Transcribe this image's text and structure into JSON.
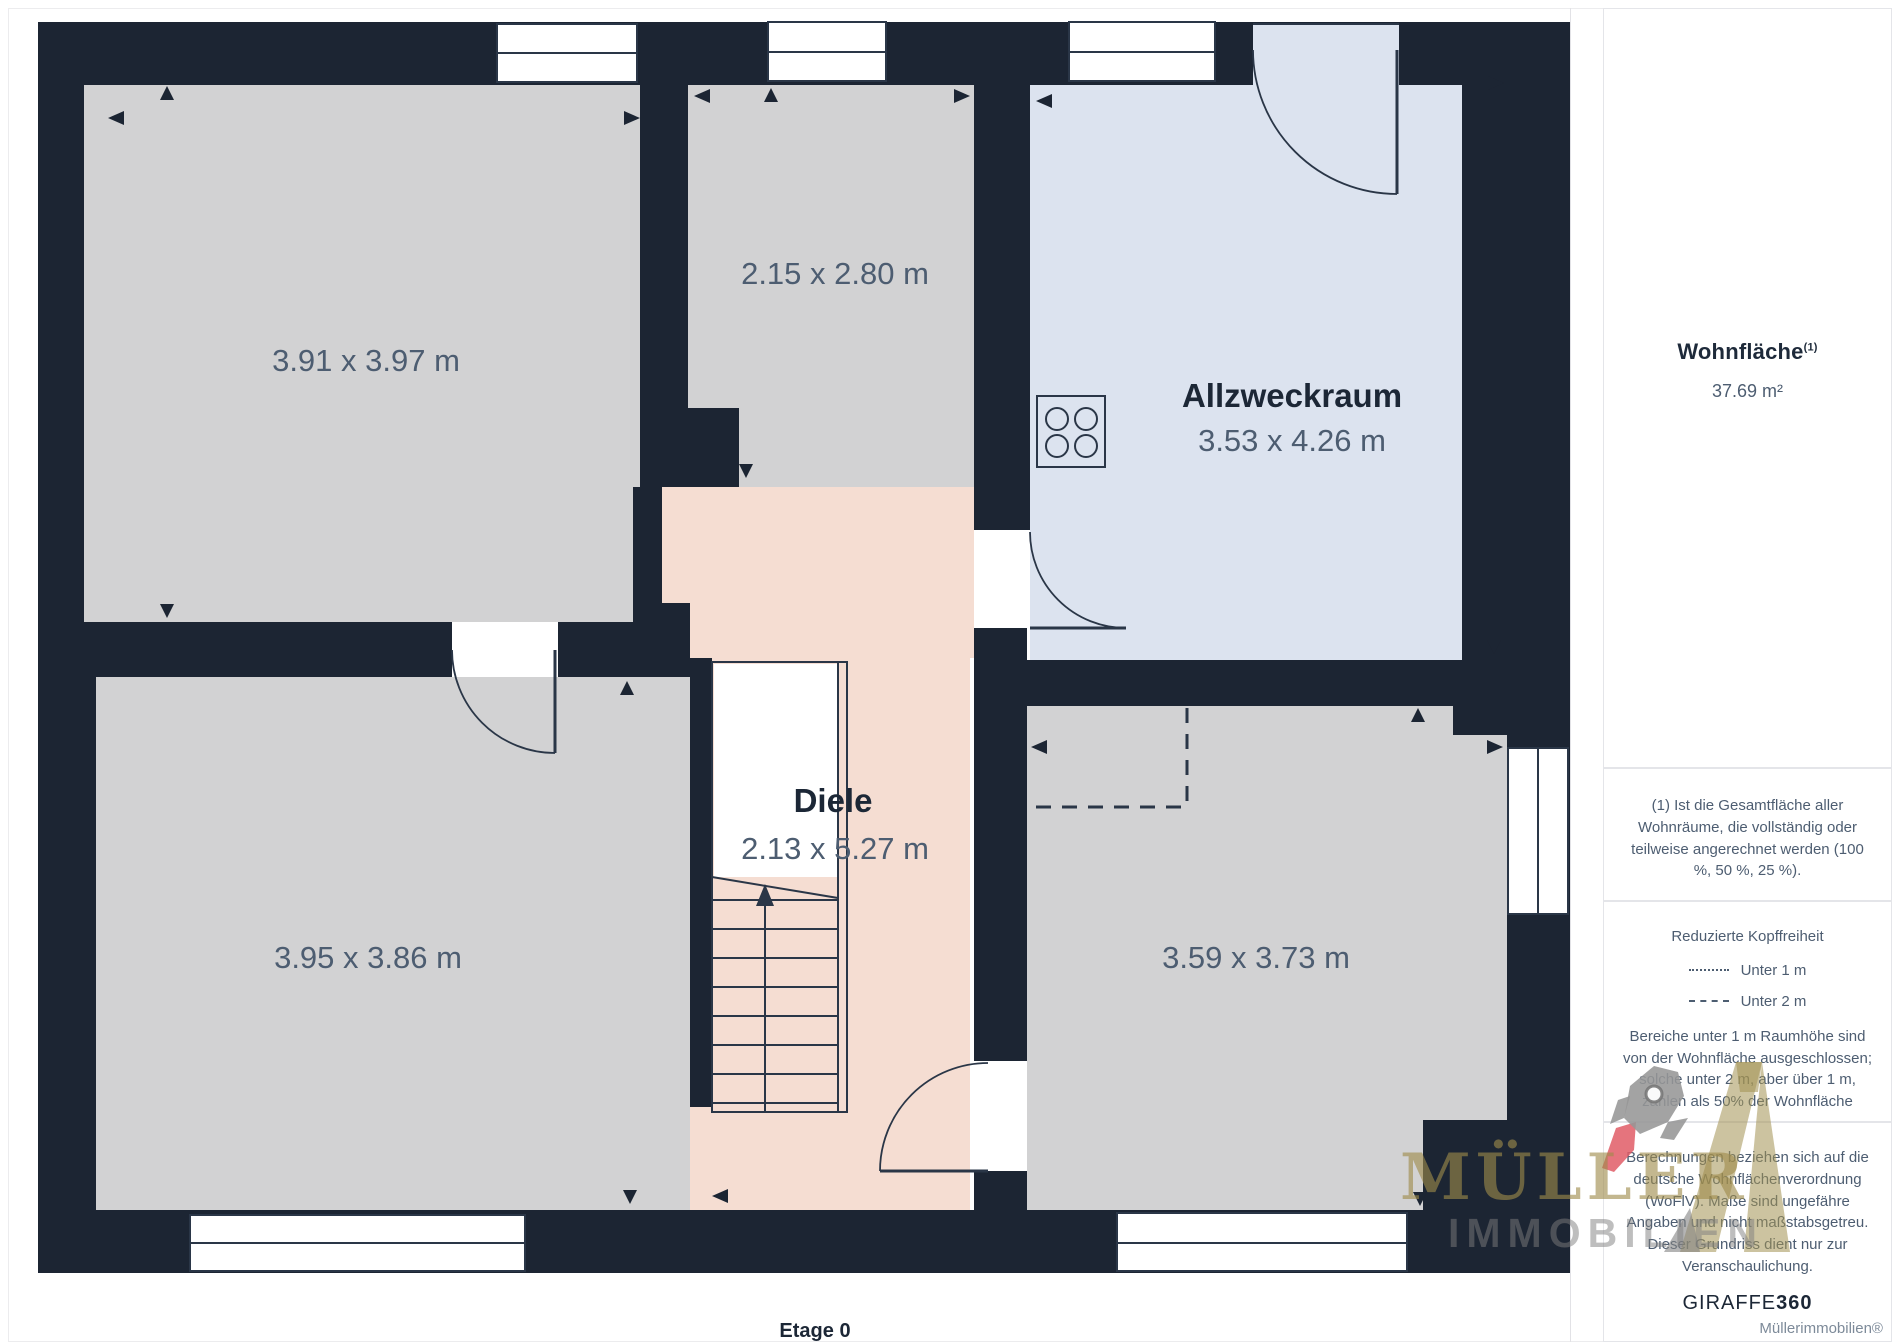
{
  "plan": {
    "floor_label": "Etage 0",
    "rooms": {
      "room_top_left": {
        "dims": "3.91 x 3.97 m"
      },
      "room_top_middle": {
        "dims": "2.15 x 2.80 m"
      },
      "allzweckraum": {
        "name": "Allzweckraum",
        "dims": "3.53 x 4.26 m"
      },
      "diele": {
        "name": "Diele",
        "dims": "2.13 x 5.27 m"
      },
      "room_bottom_left": {
        "dims": "3.95 x 3.86 m"
      },
      "room_bottom_right": {
        "dims": "3.59 x 3.73 m"
      }
    }
  },
  "sidebar": {
    "area": {
      "title": "Wohnfläche",
      "superscript": "(1)",
      "value": "37.69 m²"
    },
    "footnote": "(1) Ist die Gesamtfläche aller Wohnräume, die vollständig oder teilweise angerechnet werden (100 %, 50 %, 25 %).",
    "headroom": {
      "title": "Reduzierte Kopffreiheit",
      "legend": [
        {
          "style": "dotted",
          "label": "Unter 1 m"
        },
        {
          "style": "dashed",
          "label": "Unter 2 m"
        }
      ],
      "note": "Bereiche unter 1 m Raumhöhe sind von der Wohnfläche ausgeschlossen; solche unter 2 m, aber über 1 m, zählen als 50% der Wohnfläche"
    },
    "disclaimer": "Berechnungen beziehen sich auf die deutsche Wohnflächenverordnung (WoFlV). Maße sind ungefähre Angaben und nicht maßstabsgetreu. Dieser Grundriss dient nur zur Veranschaulichung.",
    "brand": {
      "giraffe": "GIRAFFE",
      "giraffe_suffix": "360"
    },
    "credit": "Müllerimmobilien®"
  },
  "watermark": {
    "line1": "MÜLLER",
    "line2": "IMMOBILIEN"
  },
  "colors": {
    "wall": "#1c2533",
    "room_gray": "#d2d2d3",
    "room_blue": "#dce3ef",
    "hall_pink": "#f5ddd2",
    "line": "#2a3647",
    "dim_label": "#4d5d71",
    "room_title": "#1c2736",
    "brand_khaki": "#9e8a4a",
    "flame_red": "#e05c66"
  }
}
